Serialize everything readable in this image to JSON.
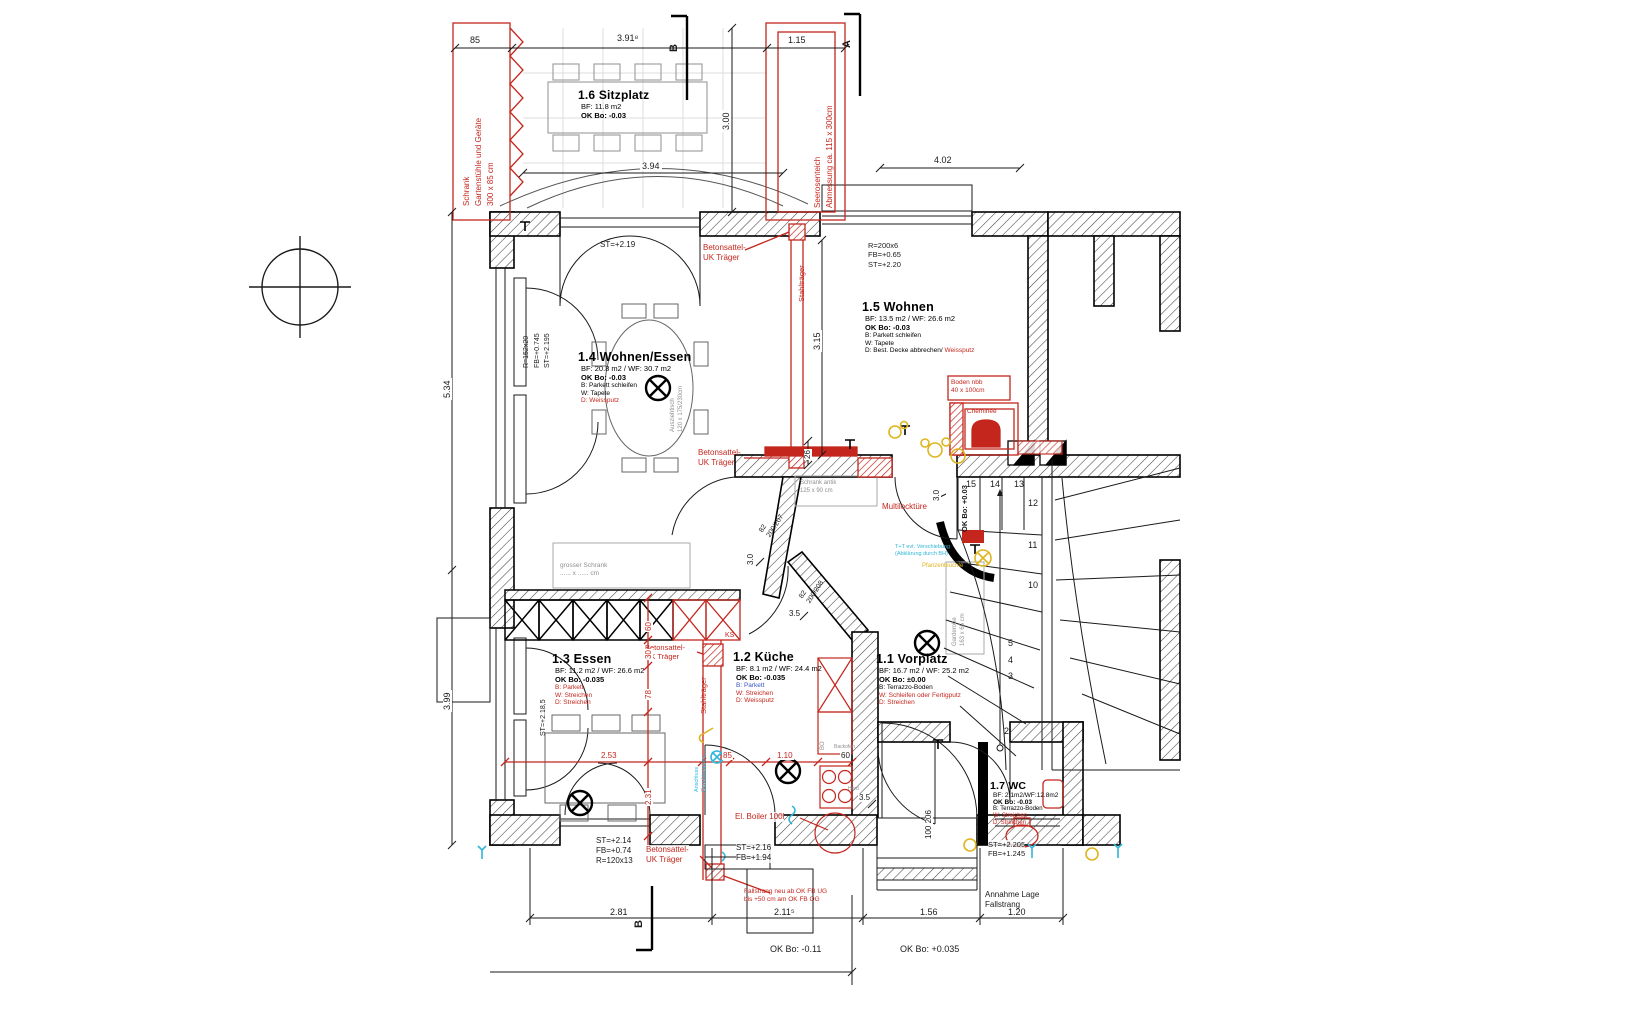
{
  "colors": {
    "red": "#c4261d",
    "cyan": "#2fb6d8",
    "yellow": "#dfb51e",
    "gray": "#8f8f8f",
    "black": "#1a1a1a"
  },
  "sections": {
    "b_top": "B",
    "a_top": "A",
    "b_bottom": "B"
  },
  "rooms": {
    "sitzplatz": {
      "title": "1.6 Sitzplatz",
      "bf": "BF: 11.8 m2",
      "ok": "OK Bo: -0.03"
    },
    "wohnen_essen": {
      "title": "1.4 Wohnen/Essen",
      "bf": "BF: 20.8 m2 / WF: 30.7 m2",
      "ok": "OK Bo: -0.03",
      "b": "B: Parkett schleifen",
      "w": "W: Tapete",
      "d": "D: Weissputz"
    },
    "wohnen": {
      "title": "1.5 Wohnen",
      "bf": "BF: 13.5 m2 / WF: 26.6 m2",
      "ok": "OK Bo: -0.03",
      "b": "B: Parkett schleifen",
      "w": "W: Tapete",
      "d1": "D: Best. Decke abbrechen/ ",
      "d2": "Weissputz"
    },
    "essen": {
      "title": "1.3 Essen",
      "bf": "BF: 11.2 m2 / WF: 26.6 m2",
      "ok": "OK Bo: -0.035",
      "b": "B: Parkett",
      "w": "W: Streichen",
      "d": "D: Streichen"
    },
    "kueche": {
      "title": "1.2 Küche",
      "bf": "BF: 8.1 m2 / WF: 24.4 m2",
      "ok": "OK Bo: -0.035",
      "b": "B: Parkett",
      "w": "W: Streichen",
      "d": "D: Weissputz"
    },
    "vorplatz": {
      "title": "1.1 Vorplatz",
      "bf": "BF: 16.7 m2 / WF: 25.2 m2",
      "ok": "OK Bo: ±0.00",
      "b": "B: Terrazzo-Boden",
      "w": "W: Schleifen oder Fertigputz",
      "d": "D: Streichen"
    },
    "wc": {
      "title": "1.7 WC",
      "bf": "BF: 2.1m2/WF:12.8m2",
      "ok": "OK Bo: -0.03",
      "b": "B: Terrazzo-Boden",
      "w": "W: Streichen",
      "d": "D: Streichen"
    }
  },
  "dims": {
    "d85": "85",
    "d391": "3.91⁸",
    "d115": "1.15",
    "d300": "3.00",
    "d394": "3.94",
    "d402": "4.02",
    "d534": "5.34",
    "d399": "3.99",
    "d315": "3.15",
    "d26": "26",
    "d281": "2.81",
    "d2115": "2.11⁵",
    "d156": "1.56",
    "d120": "1.20",
    "d253": "2.53",
    "d231": "2.31",
    "d78": "78",
    "d30": "30",
    "d60": "60",
    "d85b": "85",
    "d110": "1.10",
    "d60k": "60",
    "d30a": "3.0",
    "d30b": "3.0",
    "d35a": "3.5",
    "d35b": "3.5",
    "d100_206": "100\n206",
    "d200_207": "82\n200/207",
    "d200_208": "82\n200/208"
  },
  "levels": {
    "st219": "ST=+2.19",
    "r200": "R=200x6\nFB=+0.65\nST=+2.20",
    "r152": "R=152x20\nFB=+0.745\nST=+2.195",
    "st2185": "ST=+2.18,5",
    "st214": "ST=+2.14\nFB=+0.74\nR=120x13",
    "st216": "ST=+2.16\nFB=+1.94",
    "st2205": "ST=+2.205\nFB=+1.245",
    "okbo003": "OK Bo: +0.03",
    "okbo011": "OK Bo: -0.11",
    "okbo0035": "OK Bo: +0.035"
  },
  "red_notes": {
    "schrank": "Schrank\nGartenstühle und Geräte\n300 x 85 cm",
    "seerosenteich": "Seerosenteich\nAbmessung ca. 115 x 300cm",
    "betonsattel": "Betonsattel-\nUK Träger",
    "stahltraeger": "Stahlträger",
    "multilock": "Multilocktüre",
    "ks": "KS",
    "boiler": "El. Boiler 100l",
    "fallstrang": "Fallstrang neu ab OK FB UG\nbis +50 cm am OK FB OG",
    "boden": "Boden nbb\n40 x 100cm",
    "cheminee": "Cheminée"
  },
  "gray_notes": {
    "schrank_antik": "Schrank antik\n125 x 90 cm",
    "grosser_schrank": "grosser Schrank\n...... x ...... cm",
    "ausziehtisch": "Ausziehtisch\n120 x 175/230cm",
    "garderobe": "Garderobe\n163 x 65 cm",
    "bo": "BO",
    "backofen": "Backofen",
    "herd": "Herd"
  },
  "cyan_notes": {
    "anschluss": "Anschluss\nGeschirrspüler",
    "tt": "T+T evt. Verschiebung\n(Abklärung durch BH)"
  },
  "yellow_notes": {
    "pflanzenleuchte": "Pfanzenleuchte"
  },
  "misc": {
    "annahme": "Annahme Lage\nFallstrang"
  },
  "stairs": {
    "numbers": [
      "15",
      "14",
      "13",
      "12",
      "11",
      "10",
      "5",
      "4",
      "3",
      "2"
    ]
  }
}
